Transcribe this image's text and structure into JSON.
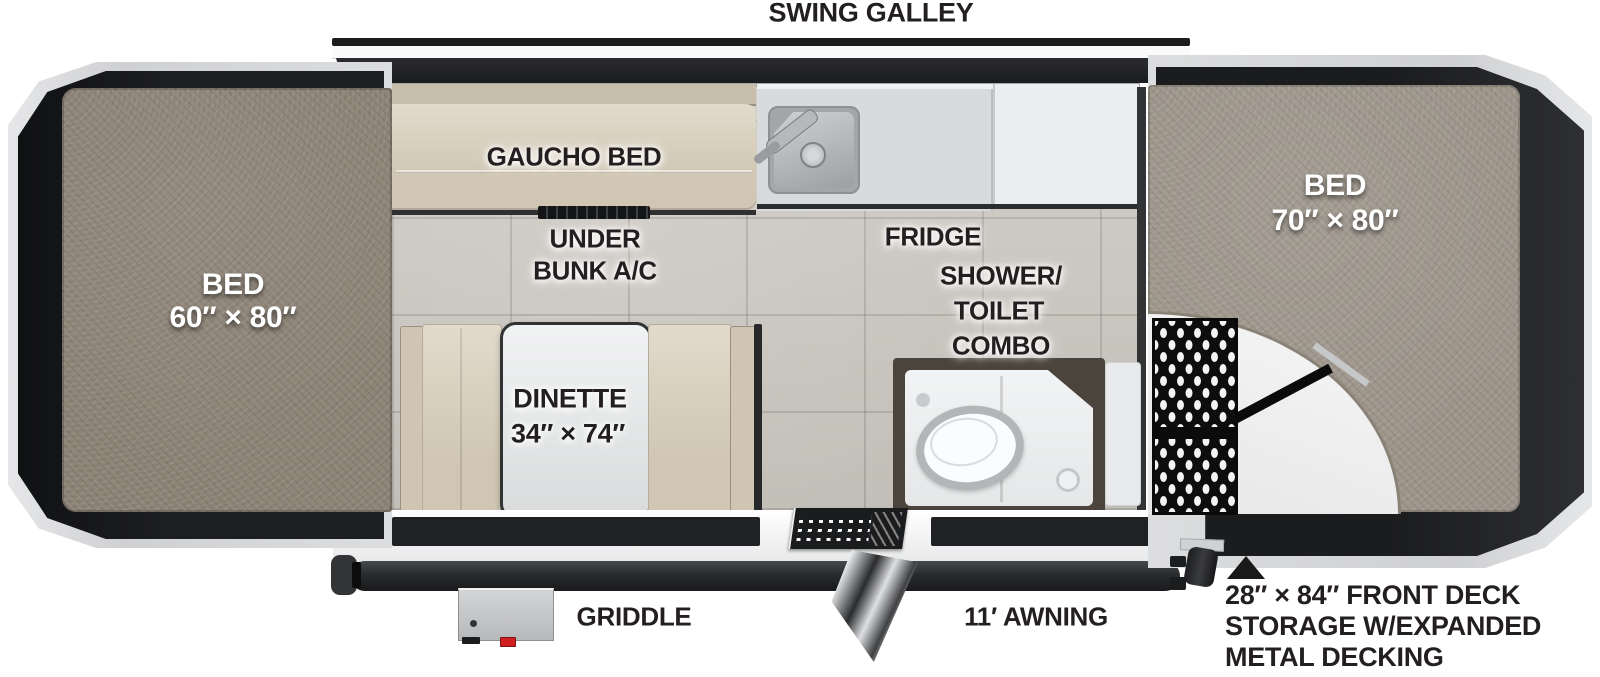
{
  "labels": {
    "swing_galley": "SWING GALLEY",
    "gaucho_bed": "GAUCHO BED",
    "under_bunk_ac": [
      "UNDER",
      "BUNK A/C"
    ],
    "fridge": "FRIDGE",
    "shower_toilet_combo": [
      "SHOWER/",
      "TOILET",
      "COMBO"
    ],
    "dinette": [
      "DINETTE",
      "34″ × 74″"
    ],
    "bed_left": [
      "BED",
      "60″ × 80″"
    ],
    "bed_right": [
      "BED",
      "70″ × 80″"
    ],
    "griddle": "GRIDDLE",
    "awning": "11′ AWNING",
    "deck_note": [
      "28″ × 84″ FRONT DECK",
      "STORAGE W/EXPANDED",
      "METAL DECKING"
    ]
  },
  "colors": {
    "background": "#ffffff",
    "label_dark": "#231f20",
    "label_light": "#ffffff",
    "mattress_left": "#8b8174",
    "mattress_right": "#9c9489",
    "cushion_tan": "#d8ceba",
    "floor_tile": "#ccc9c1",
    "counter_gray": "#d9dadc",
    "cabinet_white": "#ecedee",
    "frame_dark": "#2a2b2d",
    "platform_silver": "#d7d8d9",
    "tent_fabric": "#1d1e20",
    "mesh_black": "#0d0d0e",
    "shower_wall": "#4a443c",
    "griddle_knob_red": "#cf1f1f"
  }
}
